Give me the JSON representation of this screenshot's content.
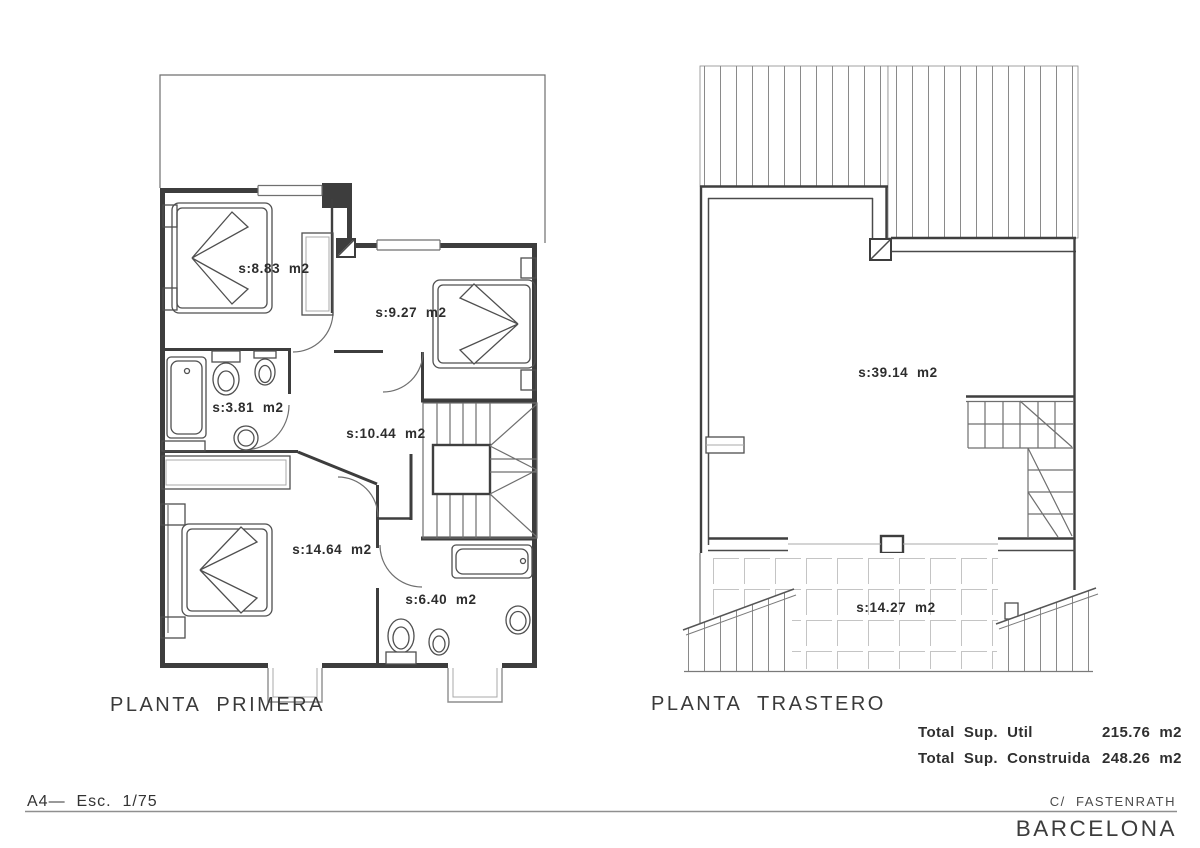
{
  "colors": {
    "background": "#ffffff",
    "wall_line": "#3d3d3d",
    "hatch_line": "#8a8a8a",
    "tile_line": "#c4c4c4",
    "text": "#2f2f2f"
  },
  "plans": {
    "primera": {
      "title": "PLANTA  PRIMERA",
      "rooms": [
        {
          "id": "bedroom-1",
          "label": "s:8.83  m2"
        },
        {
          "id": "bedroom-2",
          "label": "s:9.27  m2"
        },
        {
          "id": "bathroom-1",
          "label": "s:3.81  m2"
        },
        {
          "id": "hall",
          "label": "s:10.44  m2"
        },
        {
          "id": "bedroom-3",
          "label": "s:14.64  m2"
        },
        {
          "id": "bathroom-2",
          "label": "s:6.40  m2"
        }
      ]
    },
    "trastero": {
      "title": "PLANTA  TRASTERO",
      "rooms": [
        {
          "id": "storage-room",
          "label": "s:39.14  m2"
        },
        {
          "id": "terrace",
          "label": "s:14.27  m2"
        }
      ]
    }
  },
  "totals": {
    "util_label": "Total  Sup.  Util",
    "util_value": "215.76  m2",
    "construida_label": "Total  Sup.  Construida",
    "construida_value": "248.26  m2"
  },
  "footer": {
    "sheet": "A4—  Esc.  1/75",
    "street": "C/  FASTENRATH",
    "city": "BARCELONA"
  }
}
